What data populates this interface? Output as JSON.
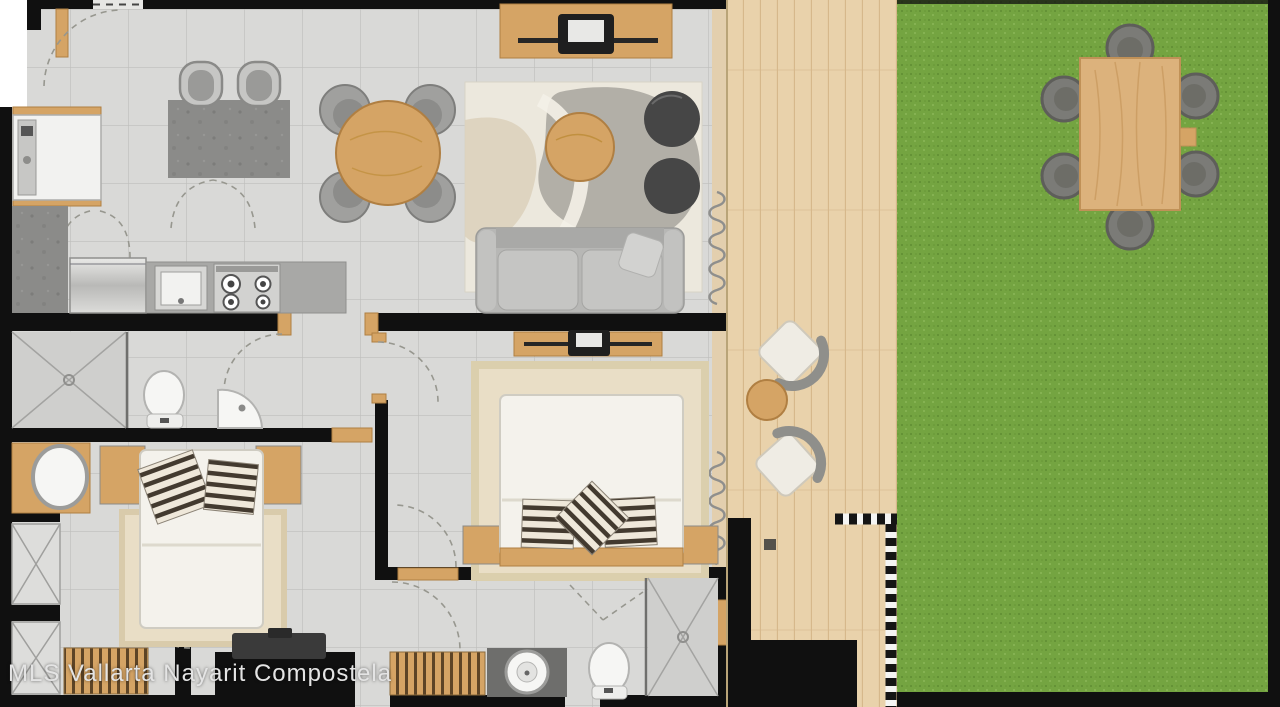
{
  "watermark": {
    "text": "MLS Vallarta Nayarit Compostela"
  },
  "palette": {
    "wall": "#101010",
    "floor": "#d9d9d7",
    "tile_line": "#b2b2b0",
    "wood": "#d5a465",
    "wood_dark": "#b07f42",
    "deck": "#e9d2ab",
    "deck_line": "#d6b88b",
    "lawn": "#74a441",
    "lawn_dark": "#5f8c33",
    "counter": "#8b8b89",
    "sofa": "#b7b7b5",
    "rug_living": "#ece8dd",
    "rug_bedroom": "#e9dec6",
    "pouf": "#464646",
    "chair": "#a0a09e",
    "bed_white": "#f4f2ec",
    "pillow_dark": "#433a2f",
    "pillow_light": "#efe8da",
    "fixture": "#f6f6f4",
    "outdoor_chair": "#7b7b77",
    "watermark": "#e4e4e4"
  }
}
